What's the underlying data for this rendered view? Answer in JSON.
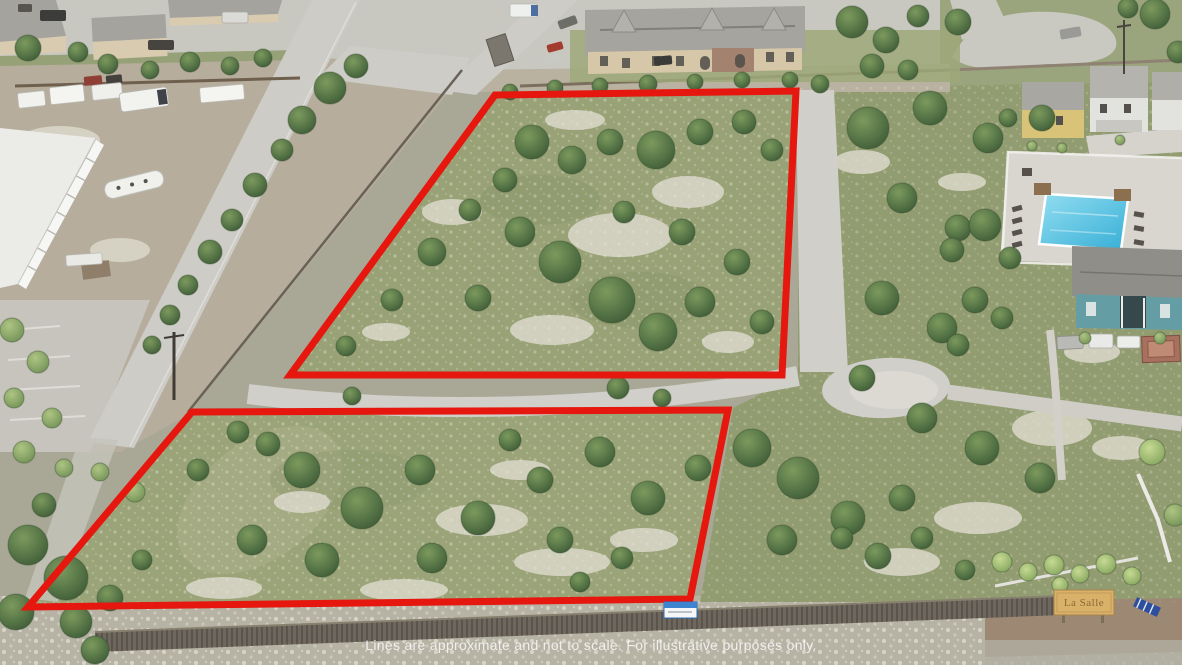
{
  "scene": {
    "kind": "aerial-drone-photo-with-property-boundary-overlay",
    "disclaimer": "Lines are approximate and not to scale. For illustrative purposes only.",
    "entrance_sign_label": "La Salle",
    "parcel_count": 2
  },
  "colors": {
    "boundary_red": "#e5170e",
    "parcel_grass": "#98a276",
    "tree_canopy": "#49663c",
    "pavement": "#cfcec8",
    "yard_dirt": "#b5ac9b",
    "pool_water": "#4ec0de",
    "picket_fence": "#6e675d",
    "sign_board_tan": "#d9b169",
    "bottom_dirt_brown": "#9d8973"
  }
}
